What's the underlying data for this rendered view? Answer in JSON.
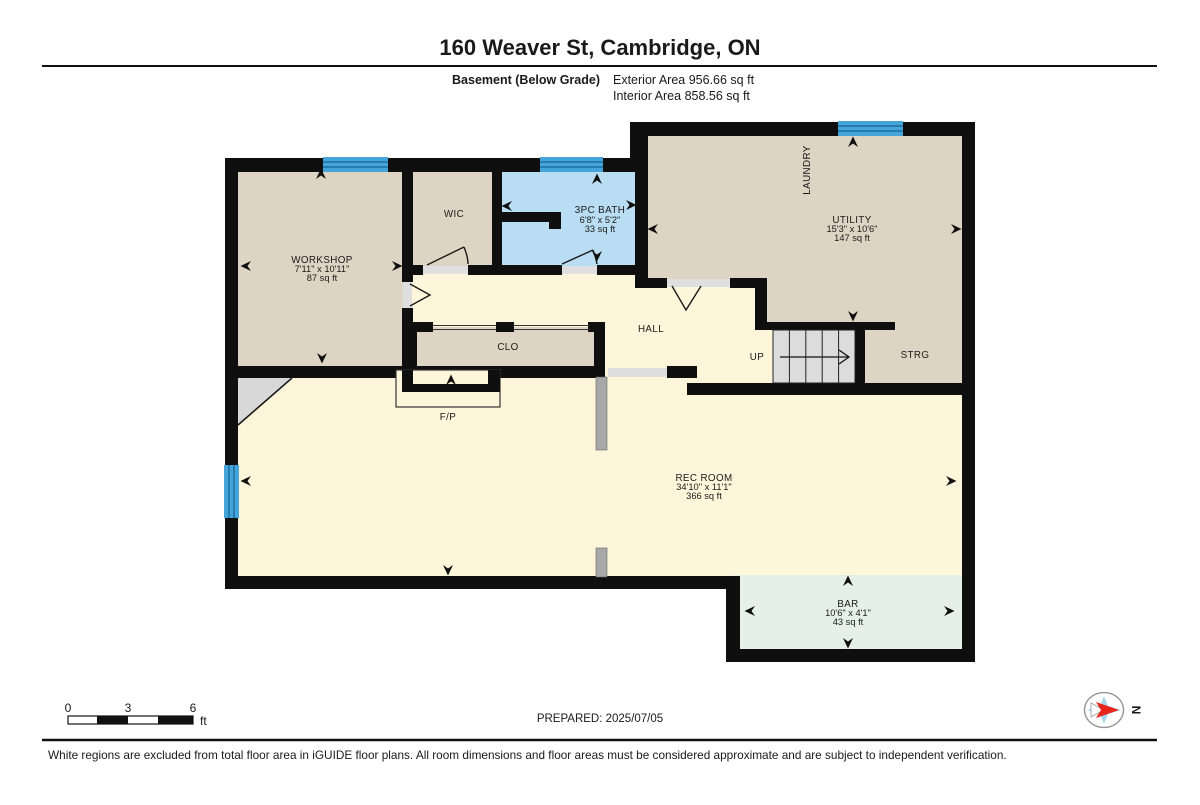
{
  "header": {
    "title": "160 Weaver St, Cambridge, ON",
    "floor_label": "Basement (Below Grade)",
    "exterior_area": "Exterior Area 956.66 sq ft",
    "interior_area": "Interior Area 858.56 sq ft"
  },
  "rooms": {
    "workshop": {
      "name": "WORKSHOP",
      "dims": "7'11\" x 10'11\"",
      "area": "87 sq ft"
    },
    "wic": {
      "name": "WIC"
    },
    "bath": {
      "name": "3PC BATH",
      "dims": "6'8\" x 5'2\"",
      "area": "33 sq ft"
    },
    "laundry": {
      "name": "LAUNDRY"
    },
    "utility": {
      "name": "UTILITY",
      "dims": "15'3\" x 10'6\"",
      "area": "147 sq ft"
    },
    "hall": {
      "name": "HALL"
    },
    "clo": {
      "name": "CLO"
    },
    "fireplace": {
      "name": "F/P"
    },
    "stairs": {
      "name": "UP"
    },
    "storage": {
      "name": "STRG"
    },
    "rec_room": {
      "name": "REC ROOM",
      "dims": "34'10\" x 11'1\"",
      "area": "366 sq ft"
    },
    "bar": {
      "name": "BAR",
      "dims": "10'6\" x 4'1\"",
      "area": "43 sq ft"
    }
  },
  "scale_bar": {
    "tick0": "0",
    "tick3": "3",
    "tick6": "6",
    "unit": "ft"
  },
  "compass": {
    "north": "N"
  },
  "footer": {
    "prepared": "PREPARED: 2025/07/05",
    "disclaimer": "White regions are excluded from total floor area in iGUIDE floor plans. All room dimensions and floor areas must be considered approximate and are subject to independent verification."
  },
  "colors": {
    "wall": "#0f0f0f",
    "room_tan": "#ded4c3",
    "room_blue": "#b9ddf2",
    "room_cream": "#fdf6da",
    "room_green": "#e4f0e8",
    "window_blue": "#45a4d9",
    "stairs_gray": "#dcdcdc",
    "column_gray": "#a8a8a8",
    "compass_red": "#e8241c",
    "compass_blue": "#a8d4ea"
  }
}
